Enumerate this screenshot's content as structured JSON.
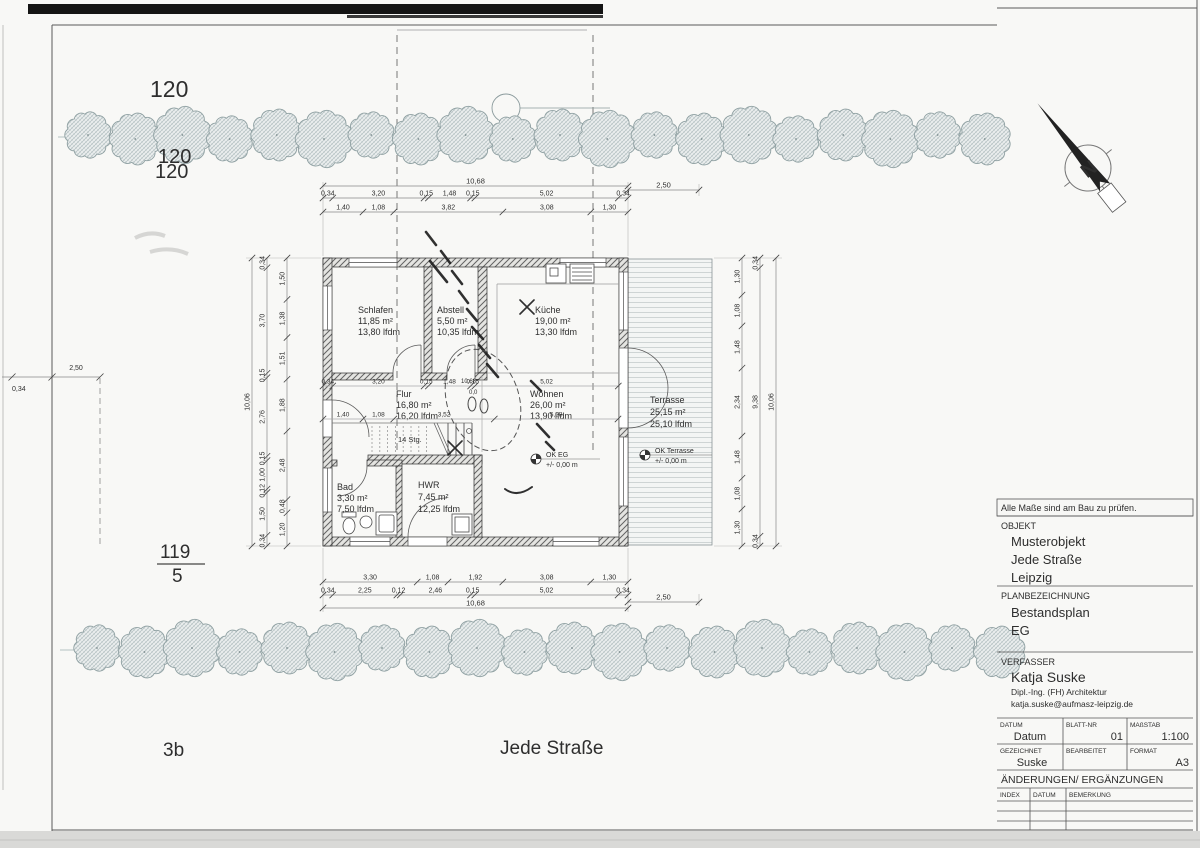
{
  "sheet": {
    "note": "Alle Maße sind am Bau zu prüfen.",
    "titleblock": {
      "objekt_label": "OBJEKT",
      "objekt_line1": "Musterobjekt",
      "objekt_line2": "Jede Straße",
      "objekt_line3": "Leipzig",
      "plan_label": "PLANBEZEICHNUNG",
      "plan_line1": "Bestandsplan",
      "plan_line2": "EG",
      "verfasser_label": "VERFASSER",
      "verfasser_name": "Katja Suske",
      "verfasser_title": "Dipl.-Ing. (FH) Architektur",
      "verfasser_email": "katja.suske@aufmasz-leipzig.de",
      "datum_label": "DATUM",
      "datum_value": "Datum",
      "blatt_label": "BLATT-NR",
      "blatt_value": "01",
      "massstab_label": "MAßSTAB",
      "massstab_value": "1:100",
      "gezeichnet_label": "GEZEICHNET",
      "gezeichnet_value": "Suske",
      "bearbeitet_label": "BEARBEITET",
      "bearbeitet_value": "",
      "format_label": "FORMAT",
      "format_value": "A3",
      "aenderungen_label": "ÄNDERUNGEN/ ERGÄNZUNGEN",
      "index_label": "INDEX",
      "datum2_label": "DATUM",
      "bemerkung_label": "BEMERKUNG"
    }
  },
  "site": {
    "parcel_top": "120",
    "parcel_top_ghost1": "120",
    "parcel_top_ghost2": "120",
    "parcel_left_num": "119",
    "parcel_left_den": "5",
    "house_number": "3b",
    "street": "Jede Straße",
    "north_letter": "N"
  },
  "rooms": [
    {
      "name": "Schlafen",
      "area": "11,85 m²",
      "lfdm": "13,80 lfdm"
    },
    {
      "name": "Abstell",
      "area": "5,50 m²",
      "lfdm": "10,35 lfdm"
    },
    {
      "name": "Küche",
      "area": "19,00 m²",
      "lfdm": "13,30 lfdm"
    },
    {
      "name": "Flur",
      "area": "16,80 m²",
      "lfdm": "16,20 lfdm"
    },
    {
      "name": "Wohnen",
      "area": "26,00 m²",
      "lfdm": "13,90 lfdm"
    },
    {
      "name": "Terrasse",
      "area": "25,15 m²",
      "lfdm": "25,10 lfdm"
    },
    {
      "name": "Bad",
      "area": "3,30 m²",
      "lfdm": "7,50 lfdm"
    },
    {
      "name": "HWR",
      "area": "7,45 m²",
      "lfdm": "12,25 lfdm"
    }
  ],
  "annotations": {
    "stairs": "14 Stg.",
    "level_eg": "OK EG",
    "level_eg_value": "+/- 0,00 m",
    "level_terrasse": "OK Terrasse",
    "level_terrasse_value": "+/- 0,00 m",
    "sketch_dim": "10,68",
    "sketch_small": "0,0"
  },
  "dims": {
    "top_total": "10,68",
    "top_row2": [
      "0,34",
      "3,20",
      "0,15",
      "1,48",
      "0,15",
      "5,02",
      "0,34"
    ],
    "top_row3": [
      "1,40",
      "1,08",
      "3,82",
      "3,08",
      "1,30"
    ],
    "top_right": "2,50",
    "bottom_row1": [
      "3,30",
      "1,08",
      "1,92",
      "3,08",
      "1,30"
    ],
    "bottom_row2": [
      "0,34",
      "2,25",
      "0,12",
      "2,46",
      "0,15",
      "5,02",
      "0,34"
    ],
    "bottom_total": "10,68",
    "bottom_right": "2,50",
    "left_outer": "10,06",
    "left_mid": [
      "0,34",
      "3,70",
      "0,15",
      "2,76",
      "0,15",
      "1,00",
      "0,12",
      "1,50",
      "0,34"
    ],
    "left_inner": [
      "1,50",
      "1,38",
      "1,51",
      "1,88",
      "2,48",
      "0,48",
      "1,20"
    ],
    "right_inner": [
      "1,30",
      "1,08",
      "1,48",
      "2,34",
      "1,48",
      "1,08",
      "1,30"
    ],
    "right_mid": [
      "0,34",
      "9,38",
      "0,34"
    ],
    "right_outer": "10,06",
    "west_a": "2,50",
    "west_b": "0,34",
    "inner_rowA": [
      "0,34",
      "3,20",
      "0,15",
      "1,48",
      "0,15",
      "5,02"
    ],
    "inner_rowB": [
      "1,40",
      "1,08",
      "3,52",
      "5,08"
    ]
  }
}
